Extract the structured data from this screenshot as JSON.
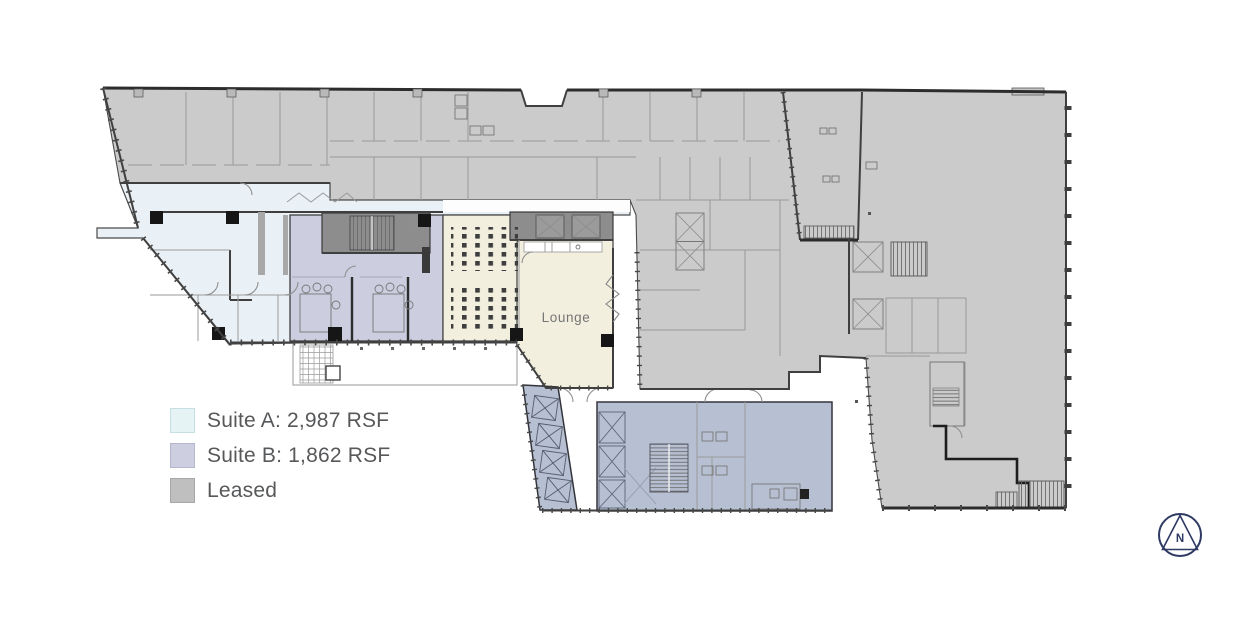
{
  "page": {
    "background": "#ffffff"
  },
  "legend": {
    "items": [
      {
        "id": "suite-a",
        "label": "Suite A: 2,987 RSF",
        "swatch": "#e5f3f5",
        "swatch_border": "#c7dee2"
      },
      {
        "id": "suite-b",
        "label": "Suite B: 1,862 RSF",
        "swatch": "#cdcfe0",
        "swatch_border": "#b4b6cd"
      },
      {
        "id": "leased",
        "label": "Leased",
        "swatch": "#bfbfbf",
        "swatch_border": "#a7a7a7"
      }
    ],
    "text_color": "#57585a"
  },
  "floorplan": {
    "lounge_label": "Lounge",
    "colors": {
      "leased": "#cbcbcb",
      "suite_a": "#eaf1f6",
      "suite_b": "#cccee0",
      "common": "#f2efde",
      "core": "#b6c0d2",
      "shaft": "#8d8d8d",
      "wall": "#4a4a4a",
      "wall_light": "#9a9a9a",
      "column": "#161616",
      "lounge_text": "#757575"
    }
  },
  "compass": {
    "label": "N",
    "color": "#2e3a64"
  }
}
